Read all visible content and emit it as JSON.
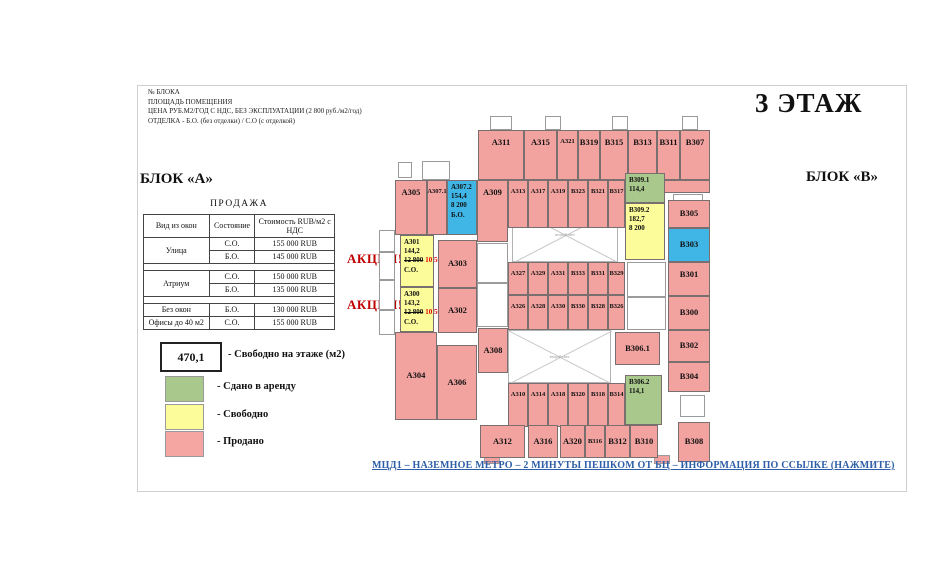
{
  "page": {
    "floor_title": "3 ЭТАЖ",
    "block_a": "БЛОК «А»",
    "block_b": "БЛОК «В»"
  },
  "header": {
    "lines": [
      "№ БЛОКА",
      "ПЛОЩАДЬ ПОМЕЩЕНИЯ",
      "ЦЕНА РУБ.М2/ГОД С НДС, БЕЗ ЭКСПЛУАТАЦИИ (2 800 руб./м2/год)",
      "ОТДЕЛКА - Б.О. (без отделки) / С.О (с отделкой)"
    ]
  },
  "promo": {
    "label": "АКЦИЯ!"
  },
  "sales_table": {
    "title": "ПРОДАЖА",
    "columns": [
      "Вид из окон",
      "Состояние",
      "Стоимость RUB/м2 с НДС"
    ],
    "groups": [
      {
        "view": "Улица",
        "rows": [
          [
            "С.О.",
            "155 000 RUB"
          ],
          [
            "Б.О.",
            "145 000 RUB"
          ]
        ],
        "spacer_after": true
      },
      {
        "view": "Атриум",
        "rows": [
          [
            "С.О.",
            "150 000 RUB"
          ],
          [
            "Б.О.",
            "135 000 RUB"
          ]
        ],
        "spacer_after": true
      },
      {
        "view": "Без окон",
        "rows": [
          [
            "Б.О.",
            "130 000 RUB"
          ]
        ],
        "spacer_after": false
      },
      {
        "view": "Офисы до 40 м2",
        "rows": [
          [
            "С.О.",
            "155 000 RUB"
          ]
        ],
        "spacer_after": false
      }
    ]
  },
  "legend": {
    "free_value": "470,1",
    "free_label": "- Свободно на этаже (м2)",
    "items": [
      {
        "color": "#a9c98c",
        "label": "- Сдано в аренду"
      },
      {
        "color": "#fcfc9b",
        "label": "- Свободно"
      },
      {
        "color": "#f5a5a2",
        "label": "- Продано"
      }
    ]
  },
  "footer": {
    "link_text": "МЦД1 – НАЗЕМНОЕ МЕТРО – 2 МИНУТЫ ПЕШКОМ ОТ БЦ – ИНФОРМАЦИЯ ПО ССЫЛКЕ (НАЖМИТЕ)"
  },
  "colors": {
    "sold": "#f2a3a0",
    "rented": "#a9c98c",
    "free": "#fcfc9b",
    "offer": "#3fb6e6",
    "promo_red": "#c00000",
    "price_red": "#e10000",
    "link_blue": "#2e5ea8"
  },
  "plan": {
    "atrium_label": "второй свет",
    "atriums": [
      {
        "x": 124,
        "y": 82,
        "w": 106,
        "h": 55
      },
      {
        "x": 120,
        "y": 205,
        "w": 103,
        "h": 53
      }
    ],
    "white_cells": [
      [
        102,
        -9,
        22,
        14
      ],
      [
        157,
        -9,
        16,
        14
      ],
      [
        224,
        -9,
        16,
        14
      ],
      [
        294,
        -9,
        16,
        14
      ],
      [
        10,
        37,
        14,
        16
      ],
      [
        34,
        36,
        28,
        19
      ],
      [
        -9,
        105,
        16,
        22
      ],
      [
        -9,
        127,
        16,
        28
      ],
      [
        -9,
        155,
        16,
        30
      ],
      [
        -9,
        185,
        16,
        25
      ],
      [
        89,
        118,
        31,
        40
      ],
      [
        89,
        158,
        31,
        44
      ],
      [
        239,
        137,
        39,
        35
      ],
      [
        239,
        172,
        39,
        33
      ],
      [
        285,
        69,
        30,
        16
      ],
      [
        292,
        270,
        25,
        22
      ]
    ],
    "pink_tabs": [
      [
        96,
        330,
        16,
        9
      ],
      [
        266,
        330,
        16,
        9
      ]
    ],
    "rooms": [
      {
        "id": "А311",
        "x": 90,
        "y": 5,
        "w": 46,
        "h": 50,
        "st": "sold"
      },
      {
        "id": "А315",
        "x": 136,
        "y": 5,
        "w": 33,
        "h": 50,
        "st": "sold"
      },
      {
        "id": "А321",
        "x": 169,
        "y": 5,
        "w": 21,
        "h": 50,
        "st": "sold"
      },
      {
        "id": "В319",
        "x": 190,
        "y": 5,
        "w": 22,
        "h": 50,
        "st": "sold"
      },
      {
        "id": "В315",
        "x": 212,
        "y": 5,
        "w": 28,
        "h": 50,
        "st": "sold"
      },
      {
        "id": "В313",
        "x": 240,
        "y": 5,
        "w": 29,
        "h": 50,
        "st": "sold"
      },
      {
        "id": "В311",
        "x": 269,
        "y": 5,
        "w": 23,
        "h": 50,
        "st": "sold"
      },
      {
        "id": "В307",
        "x": 292,
        "y": 5,
        "w": 30,
        "h": 50,
        "st": "sold"
      },
      {
        "id": "",
        "x": 274,
        "y": 55,
        "w": 48,
        "h": 13,
        "st": "sold"
      },
      {
        "id": "А305",
        "x": 7,
        "y": 55,
        "w": 32,
        "h": 55,
        "st": "sold"
      },
      {
        "id": "А307.1",
        "x": 39,
        "y": 55,
        "w": 20,
        "h": 55,
        "st": "sold"
      },
      {
        "id": "А307.2",
        "x": 59,
        "y": 55,
        "w": 30,
        "h": 55,
        "st": "offer",
        "lines": [
          {
            "t": "А307.2"
          },
          {
            "t": "154,4"
          },
          {
            "t": "8 200"
          },
          {
            "t": "Б.О."
          }
        ]
      },
      {
        "id": "А309",
        "x": 89,
        "y": 55,
        "w": 31,
        "h": 62,
        "st": "sold"
      },
      {
        "id": "А313",
        "x": 120,
        "y": 55,
        "w": 20,
        "h": 48,
        "st": "sold"
      },
      {
        "id": "А317",
        "x": 140,
        "y": 55,
        "w": 20,
        "h": 48,
        "st": "sold"
      },
      {
        "id": "А319",
        "x": 160,
        "y": 55,
        "w": 20,
        "h": 48,
        "st": "sold"
      },
      {
        "id": "В323",
        "x": 180,
        "y": 55,
        "w": 20,
        "h": 48,
        "st": "sold"
      },
      {
        "id": "В321",
        "x": 200,
        "y": 55,
        "w": 20,
        "h": 48,
        "st": "sold"
      },
      {
        "id": "В317",
        "x": 220,
        "y": 55,
        "w": 17,
        "h": 48,
        "st": "sold"
      },
      {
        "id": "В309.1",
        "x": 237,
        "y": 48,
        "w": 40,
        "h": 30,
        "st": "rented",
        "lines": [
          {
            "t": "В309.1"
          },
          {
            "t": "114,4"
          }
        ]
      },
      {
        "id": "В309.2",
        "x": 237,
        "y": 78,
        "w": 40,
        "h": 57,
        "st": "free",
        "lines": [
          {
            "t": "В309.2"
          },
          {
            "t": "182,7"
          },
          {
            "t": "8 200"
          }
        ]
      },
      {
        "id": "В305",
        "x": 280,
        "y": 75,
        "w": 42,
        "h": 28,
        "st": "sold"
      },
      {
        "id": "В303",
        "x": 280,
        "y": 103,
        "w": 42,
        "h": 34,
        "st": "offer"
      },
      {
        "id": "В301",
        "x": 280,
        "y": 137,
        "w": 42,
        "h": 34,
        "st": "sold"
      },
      {
        "id": "В300",
        "x": 280,
        "y": 171,
        "w": 42,
        "h": 34,
        "st": "sold"
      },
      {
        "id": "В302",
        "x": 280,
        "y": 205,
        "w": 42,
        "h": 32,
        "st": "sold"
      },
      {
        "id": "В304",
        "x": 280,
        "y": 237,
        "w": 42,
        "h": 30,
        "st": "sold"
      },
      {
        "id": "В308",
        "x": 290,
        "y": 297,
        "w": 32,
        "h": 40,
        "st": "sold"
      },
      {
        "id": "А301",
        "x": 12,
        "y": 110,
        "w": 34,
        "h": 52,
        "st": "free",
        "lines": [
          {
            "t": "А301"
          },
          {
            "t": "144,2"
          },
          {
            "old": "12 800",
            "new": "10 500"
          },
          {
            "t": "С.О."
          }
        ]
      },
      {
        "id": "А300",
        "x": 12,
        "y": 162,
        "w": 34,
        "h": 45,
        "st": "free",
        "lines": [
          {
            "t": "А300"
          },
          {
            "t": "143,2"
          },
          {
            "old": "12 800",
            "new": "10 500"
          },
          {
            "t": "С.О."
          }
        ]
      },
      {
        "id": "А303",
        "x": 50,
        "y": 115,
        "w": 39,
        "h": 48,
        "st": "sold"
      },
      {
        "id": "А302",
        "x": 50,
        "y": 163,
        "w": 39,
        "h": 45,
        "st": "sold"
      },
      {
        "id": "А327",
        "x": 120,
        "y": 137,
        "w": 20,
        "h": 33,
        "st": "sold"
      },
      {
        "id": "А329",
        "x": 140,
        "y": 137,
        "w": 20,
        "h": 33,
        "st": "sold"
      },
      {
        "id": "А331",
        "x": 160,
        "y": 137,
        "w": 20,
        "h": 33,
        "st": "sold"
      },
      {
        "id": "В333",
        "x": 180,
        "y": 137,
        "w": 20,
        "h": 33,
        "st": "sold"
      },
      {
        "id": "В331",
        "x": 200,
        "y": 137,
        "w": 20,
        "h": 33,
        "st": "sold"
      },
      {
        "id": "В329",
        "x": 220,
        "y": 137,
        "w": 17,
        "h": 33,
        "st": "sold"
      },
      {
        "id": "А326",
        "x": 120,
        "y": 170,
        "w": 20,
        "h": 35,
        "st": "sold"
      },
      {
        "id": "А328",
        "x": 140,
        "y": 170,
        "w": 20,
        "h": 35,
        "st": "sold"
      },
      {
        "id": "А330",
        "x": 160,
        "y": 170,
        "w": 20,
        "h": 35,
        "st": "sold"
      },
      {
        "id": "В330",
        "x": 180,
        "y": 170,
        "w": 20,
        "h": 35,
        "st": "sold"
      },
      {
        "id": "В328",
        "x": 200,
        "y": 170,
        "w": 20,
        "h": 35,
        "st": "sold"
      },
      {
        "id": "В326",
        "x": 220,
        "y": 170,
        "w": 17,
        "h": 35,
        "st": "sold"
      },
      {
        "id": "В306.1",
        "x": 227,
        "y": 207,
        "w": 45,
        "h": 33,
        "st": "sold"
      },
      {
        "id": "А304",
        "x": 7,
        "y": 207,
        "w": 42,
        "h": 88,
        "st": "sold"
      },
      {
        "id": "А306",
        "x": 49,
        "y": 220,
        "w": 40,
        "h": 75,
        "st": "sold"
      },
      {
        "id": "А308",
        "x": 90,
        "y": 203,
        "w": 30,
        "h": 45,
        "st": "sold"
      },
      {
        "id": "А310",
        "x": 120,
        "y": 258,
        "w": 20,
        "h": 44,
        "st": "sold"
      },
      {
        "id": "А314",
        "x": 140,
        "y": 258,
        "w": 20,
        "h": 44,
        "st": "sold"
      },
      {
        "id": "А318",
        "x": 160,
        "y": 258,
        "w": 20,
        "h": 44,
        "st": "sold"
      },
      {
        "id": "В320",
        "x": 180,
        "y": 258,
        "w": 20,
        "h": 44,
        "st": "sold"
      },
      {
        "id": "В318",
        "x": 200,
        "y": 258,
        "w": 20,
        "h": 44,
        "st": "sold"
      },
      {
        "id": "В314",
        "x": 220,
        "y": 258,
        "w": 17,
        "h": 44,
        "st": "sold"
      },
      {
        "id": "В306.2",
        "x": 237,
        "y": 250,
        "w": 37,
        "h": 50,
        "st": "rented",
        "lines": [
          {
            "t": "В306.2"
          },
          {
            "t": "114,1"
          }
        ]
      },
      {
        "id": "А312",
        "x": 92,
        "y": 300,
        "w": 45,
        "h": 33,
        "st": "sold"
      },
      {
        "id": "А316",
        "x": 140,
        "y": 300,
        "w": 30,
        "h": 33,
        "st": "sold"
      },
      {
        "id": "А320",
        "x": 172,
        "y": 300,
        "w": 25,
        "h": 33,
        "st": "sold"
      },
      {
        "id": "В316",
        "x": 197,
        "y": 300,
        "w": 20,
        "h": 33,
        "st": "sold"
      },
      {
        "id": "В312",
        "x": 217,
        "y": 300,
        "w": 25,
        "h": 33,
        "st": "sold"
      },
      {
        "id": "В310",
        "x": 242,
        "y": 300,
        "w": 28,
        "h": 33,
        "st": "sold"
      }
    ]
  }
}
